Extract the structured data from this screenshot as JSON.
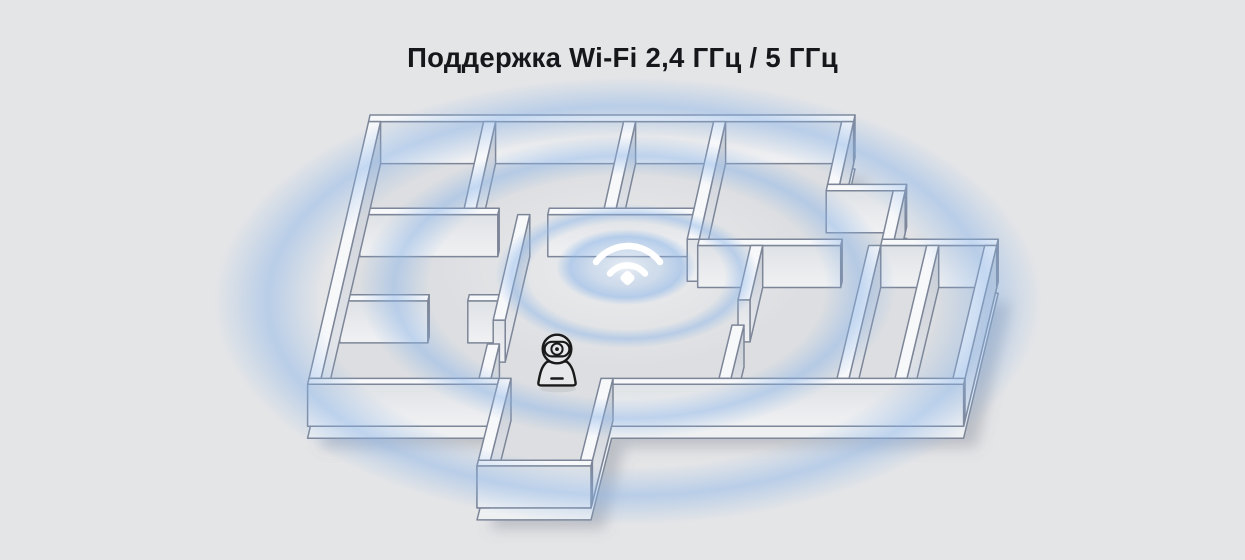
{
  "title": {
    "text": "Поддержка Wi-Fi 2,4 ГГц / 5 ГГц"
  },
  "illustration": {
    "background_color": "#e4e5e7",
    "wave_color": "#8ab4e8",
    "wall_line_color": "#7d8698",
    "title_color": "#15171b",
    "wifi_icon_color": "#ffffff",
    "camera_icon_color": "#1a1a1a",
    "icons": [
      {
        "name": "wifi-signal-icon"
      },
      {
        "name": "security-camera-icon"
      }
    ]
  }
}
